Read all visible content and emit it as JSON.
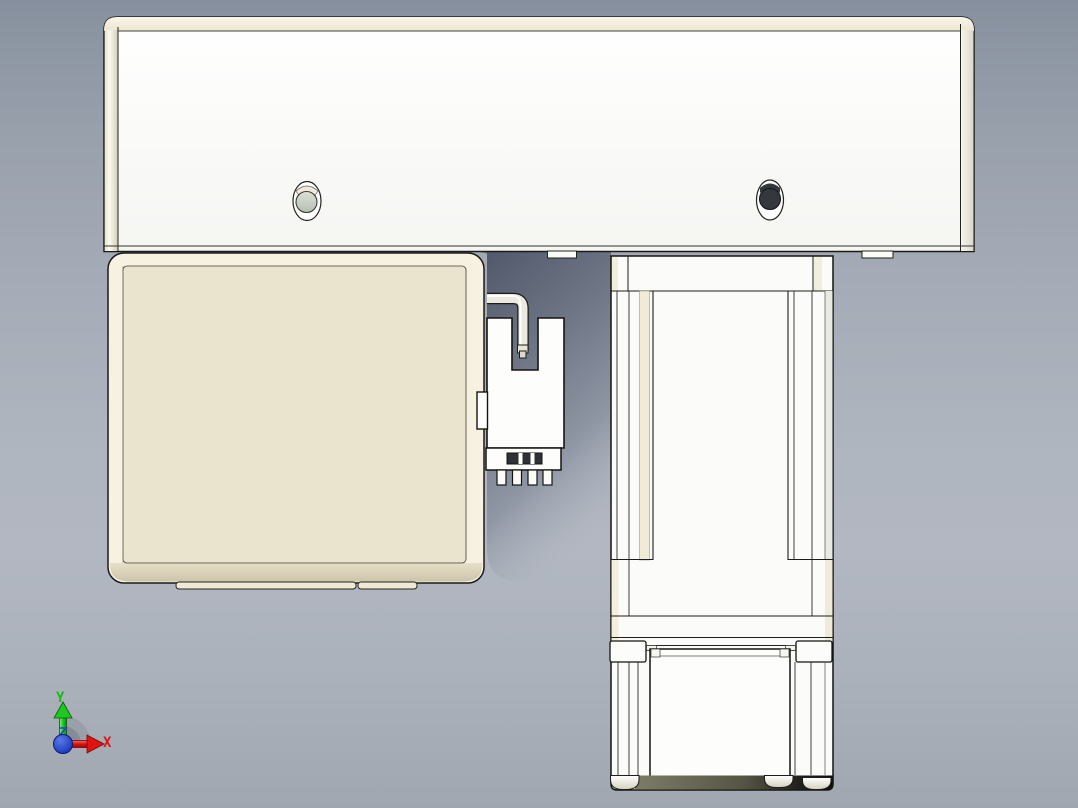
{
  "viewport": {
    "title": "cad-model-view",
    "triad": {
      "x_label": "X",
      "y_label": "Y",
      "x_color": "#e01212",
      "y_color": "#15bd15",
      "z_color": "#1f46cf"
    },
    "colors": {
      "background_top": "#87909e",
      "background_mid": "#b2b7c1",
      "background_bottom": "#a1a7b1",
      "part_white": "#fcfcfa",
      "part_cream_face": "#eae4cf",
      "part_cream_edge": "#f6f1e1",
      "cream_stripe": "#f0ebd5",
      "outline": "#1a1a1a",
      "hole_dark_fill": "#34383d",
      "hole_light_fill": "#cdd3c9",
      "cavity_shadow": "#535b6c",
      "base_shadow_dark": "#0e0e0c",
      "base_shadow_olive": "#7c7c66"
    }
  }
}
